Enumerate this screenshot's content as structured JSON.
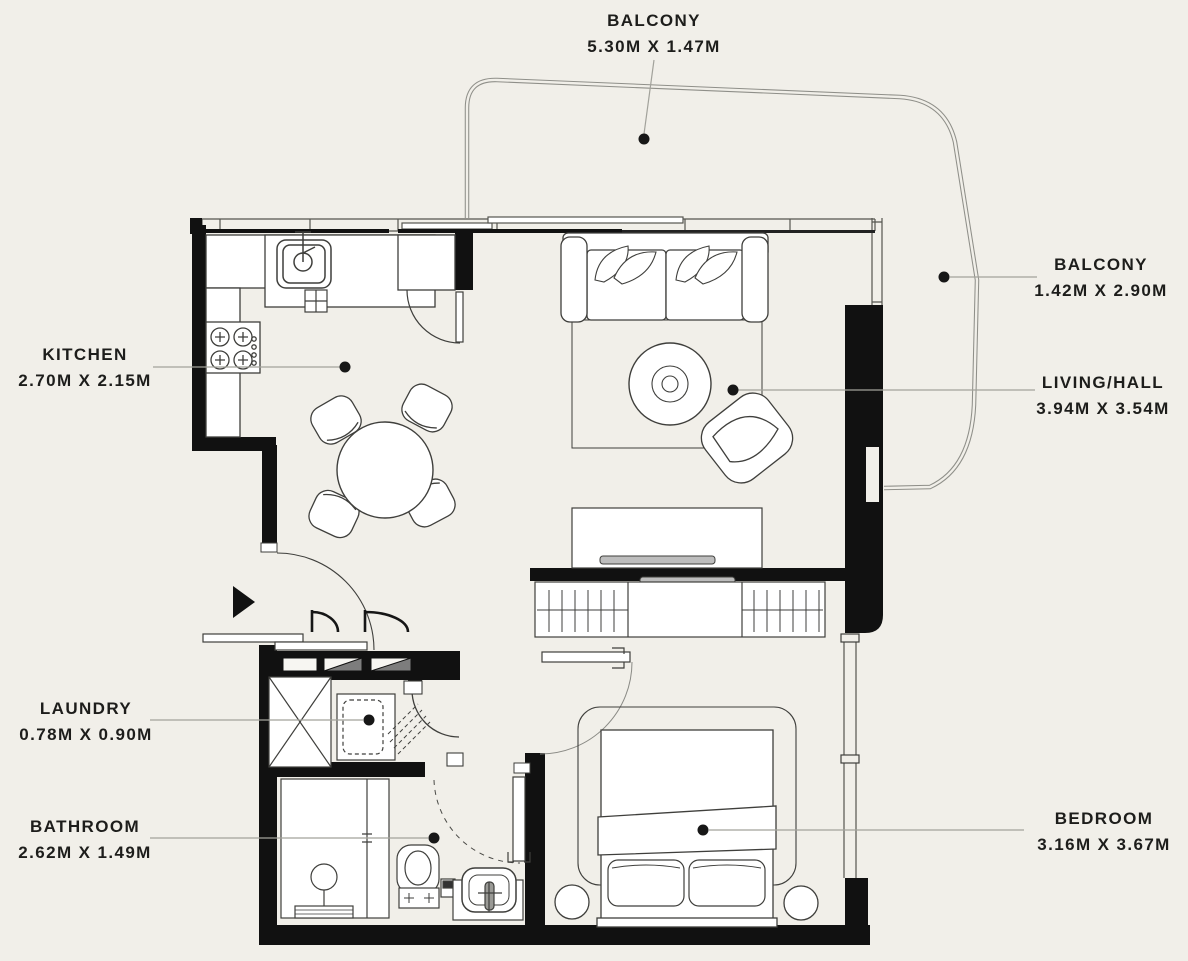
{
  "page": {
    "type": "apartment-floor-plan"
  },
  "colors": {
    "background": "#f1efe9",
    "wall": "#111111",
    "furniture_line": "#3f3f3c",
    "window_line": "#55554f",
    "balcony_line": "#8f8f89",
    "leader": "#a2a29b",
    "dot": "#171717",
    "text": "#1d1d1b",
    "hatch_gray": "#7d7d7d",
    "tv_gray": "#bdbdbd"
  },
  "rooms": [
    {
      "id": "balcony-top",
      "name": "BALCONY",
      "dims": "5.30M X 1.47M"
    },
    {
      "id": "balcony-right",
      "name": "BALCONY",
      "dims": "1.42M X 2.90M"
    },
    {
      "id": "living-hall",
      "name": "LIVING/HALL",
      "dims": "3.94M X 3.54M"
    },
    {
      "id": "kitchen",
      "name": "KITCHEN",
      "dims": "2.70M X 2.15M"
    },
    {
      "id": "laundry",
      "name": "LAUNDRY",
      "dims": "0.78M X 0.90M"
    },
    {
      "id": "bathroom",
      "name": "BATHROOM",
      "dims": "2.62M X 1.49M"
    },
    {
      "id": "bedroom",
      "name": "BEDROOM",
      "dims": "3.16M X 3.67M"
    }
  ]
}
